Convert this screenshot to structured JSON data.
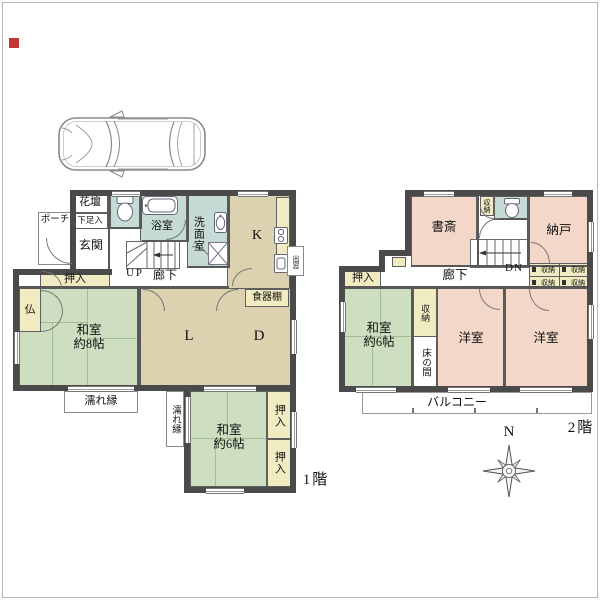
{
  "colors": {
    "wall": "#4a4a4a",
    "tatami_green": "#cddfc0",
    "wood_floor": "#dcd2b0",
    "wet_area_blue": "#c6dad6",
    "closet_cream": "#f1ebc2",
    "western_pink": "#f3d8c9",
    "marker_red": "#c53434"
  },
  "floor1": {
    "caption": "1階",
    "porch": "ポーチ",
    "flower_bed": "花壇",
    "shoe_cabinet": "下足入",
    "entrance": "玄関",
    "bathroom": "浴室",
    "washroom": "洗面室",
    "kitchen": "K",
    "bay_window": "出窓",
    "stairs_up": "UP",
    "hallway": "廊下",
    "closet_nw": "押入",
    "altar": "仏",
    "washitsu8_name": "和室",
    "washitsu8_size": "約8帖",
    "living": "L",
    "dining": "D",
    "cupboard": "食器棚",
    "veranda_south": "濡れ縁",
    "veranda_east": "濡れ縁",
    "washitsu6_name": "和室",
    "washitsu6_size": "約6帖",
    "closet_e_top": "押入",
    "closet_e_bottom": "押入"
  },
  "floor2": {
    "caption": "2階",
    "study": "書斎",
    "storage_wc": "収納",
    "storeroom": "納戸",
    "closet_w": "押入",
    "hallway": "廊下",
    "stairs_down": "DN",
    "storage_grid": [
      "収納",
      "収納",
      "収納",
      "収納"
    ],
    "washitsu6_name": "和室",
    "washitsu6_size": "約6帖",
    "storage_v": "収納",
    "tokonoma": "床の間",
    "western_a": "洋室",
    "western_b": "洋室",
    "balcony": "バルコニー"
  },
  "compass": {
    "north": "N"
  }
}
